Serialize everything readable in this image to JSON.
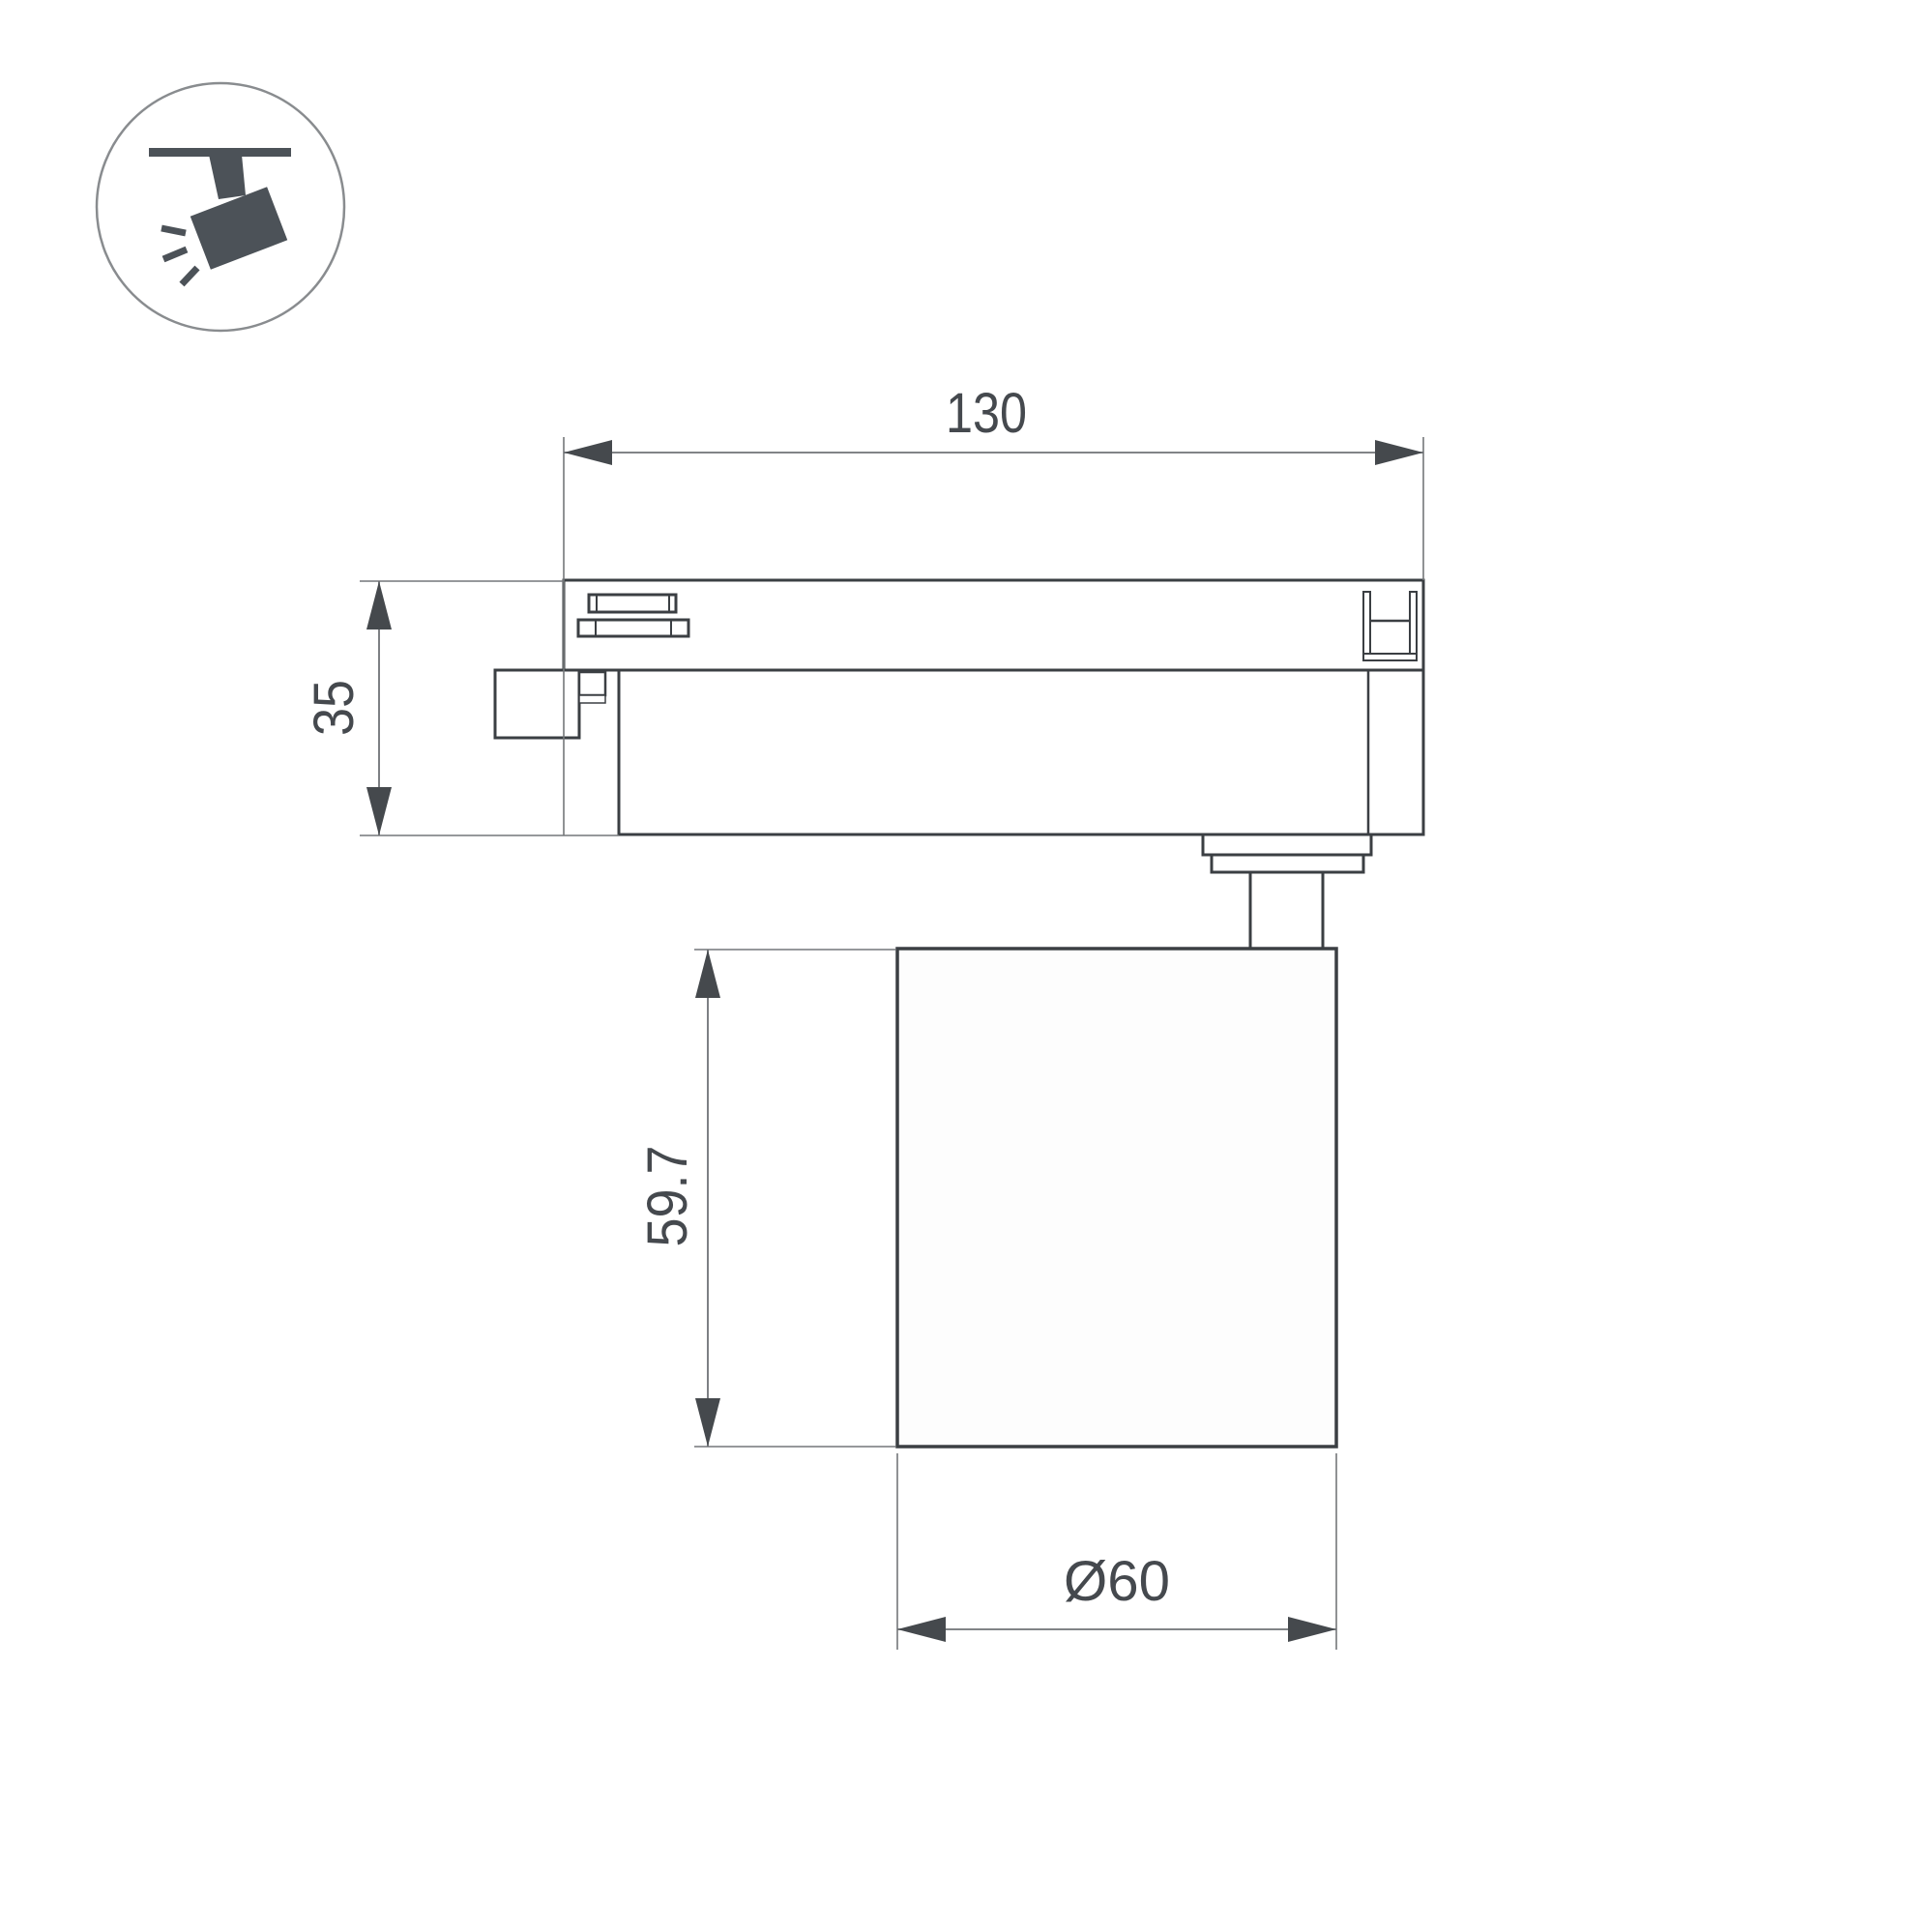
{
  "icon": {
    "name": "track-spotlight-icon"
  },
  "dims": {
    "track_length": "130",
    "adapter_height": "35",
    "lamp_height": "59.7",
    "lamp_diameter": "Ø60"
  },
  "colors": {
    "outline": "#3b3f43",
    "thin_line": "#74777a",
    "annotation": "#45494e",
    "icon_fill": "#4c5258",
    "background": "#ffffff"
  }
}
